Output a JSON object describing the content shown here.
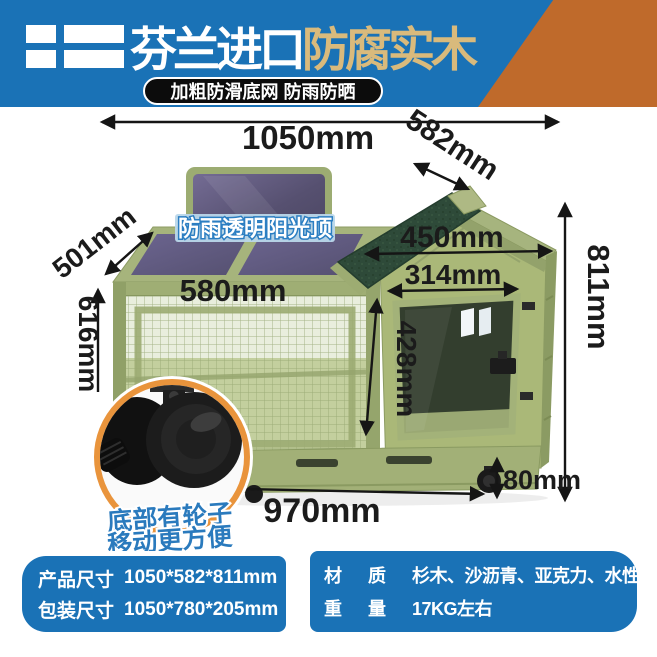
{
  "colors": {
    "banner_blue": "#1a72b6",
    "banner_orange": "#bf6a2b",
    "title_gold": "#d9ba7c",
    "badge_black": "#0c0c0c",
    "spec_box_blue": "#1a72b6",
    "note_blue": "#2a7abd",
    "wood_green": "#a6b47c",
    "roof_dark_green": "#2e4a39",
    "wheel_ring_orange": "#e9943c"
  },
  "banner": {
    "flag_icon": "finland-flag-icon",
    "title_white": "芬兰进口",
    "title_gold": "防腐实木",
    "badge": "加粗防滑底网 防雨防晒"
  },
  "diagram": {
    "roof_label": "防雨透明阳光顶",
    "wheel_note1": "底部有轮子",
    "wheel_note2": "移动更方便",
    "dims": {
      "total_width": "1050mm",
      "depth": "582mm",
      "roof_slope": "501mm",
      "cage_height": "616mm",
      "top_width": "580mm",
      "roof_width": "450mm",
      "door_width": "314mm",
      "door_height": "428mm",
      "total_height": "811mm",
      "wheel_height": "80mm",
      "base_width": "970mm"
    }
  },
  "specs": {
    "product_size_label": "产品尺寸",
    "product_size_value": "1050*582*811mm",
    "package_size_label": "包装尺寸",
    "package_size_value": "1050*780*205mm",
    "material_label": "材",
    "material_label2": "质",
    "material_value": "杉木、沙沥青、亚克力、水性漆",
    "weight_label": "重",
    "weight_label2": "量",
    "weight_value": "17KG左右"
  }
}
